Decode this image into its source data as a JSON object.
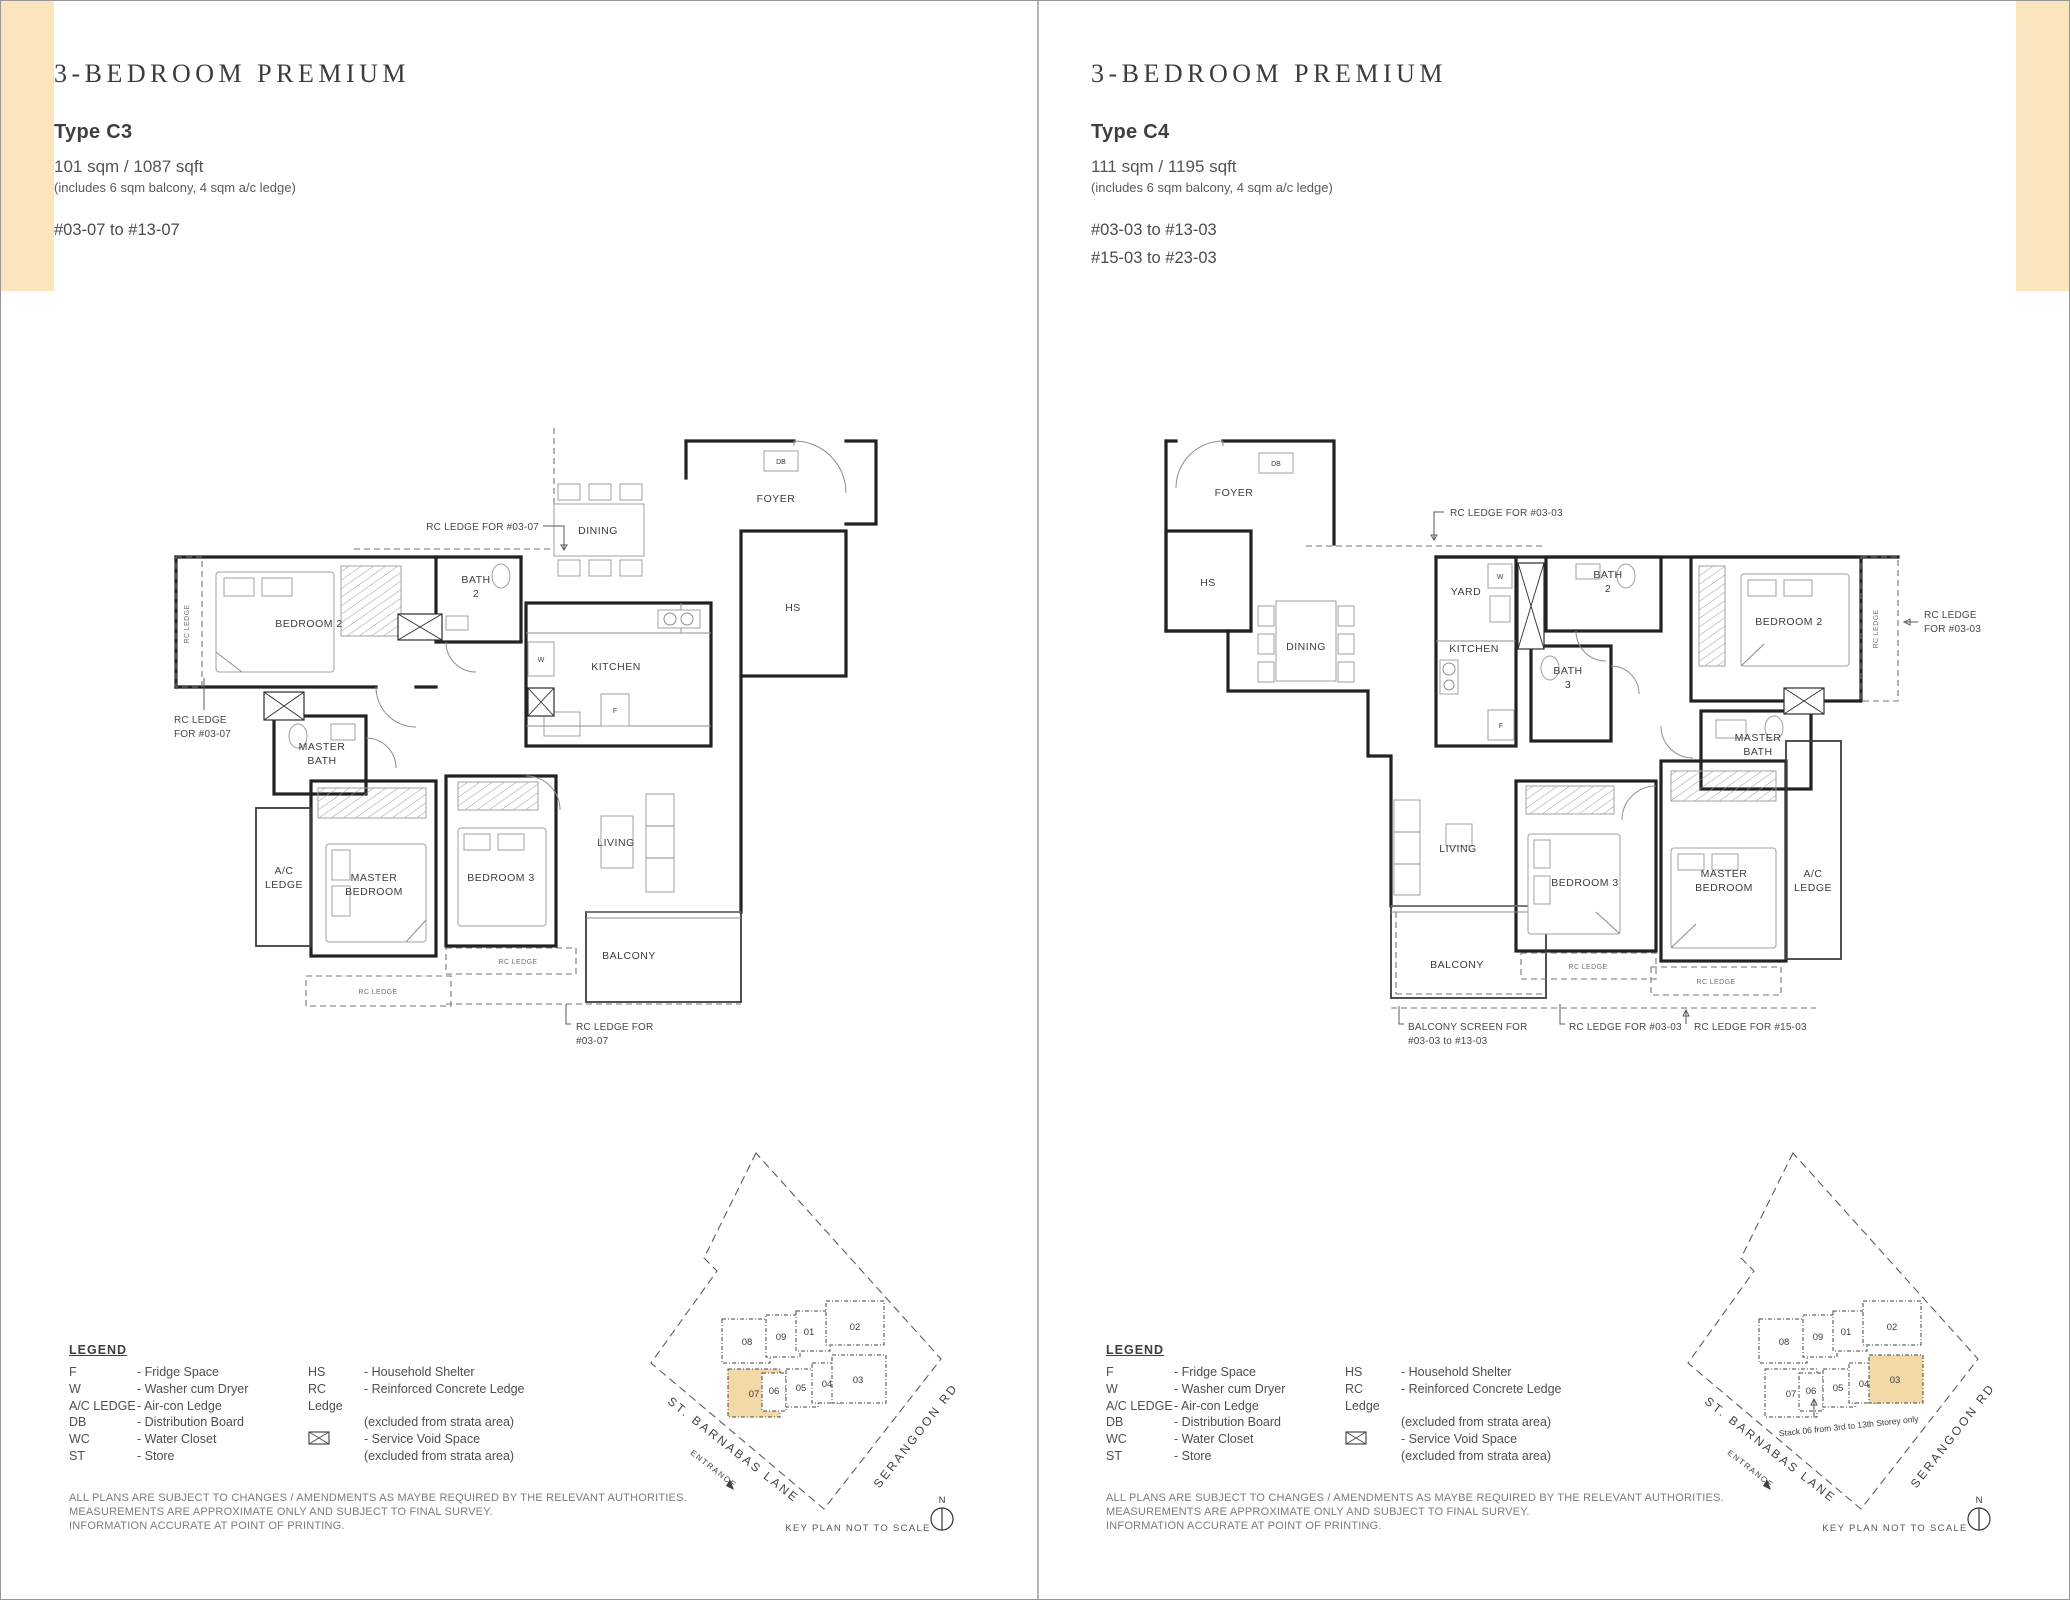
{
  "page": {
    "tab_color": "#fae5bd",
    "keyplan_highlight_color": "#f3d9a8"
  },
  "legend": {
    "heading": "LEGEND",
    "col1": [
      {
        "abbr": "F",
        "desc": "- Fridge Space"
      },
      {
        "abbr": "W",
        "desc": "- Washer cum Dryer"
      },
      {
        "abbr": "A/C LEDGE",
        "desc": "- Air-con Ledge"
      },
      {
        "abbr": "DB",
        "desc": "- Distribution Board"
      },
      {
        "abbr": "WC",
        "desc": "- Water Closet"
      },
      {
        "abbr": "ST",
        "desc": "- Store"
      }
    ],
    "col2_hs": {
      "abbr": "HS",
      "desc": "- Household Shelter"
    },
    "col2_rc": {
      "abbr": "RC Ledge",
      "desc": "- Reinforced Concrete Ledge",
      "desc2": "(excluded from strata area)"
    },
    "col2_sv": {
      "desc": "- Service Void Space",
      "desc2": "(excluded from strata area)"
    }
  },
  "disclaimer": [
    "ALL PLANS ARE SUBJECT TO CHANGES / AMENDMENTS AS MAYBE REQUIRED BY THE RELEVANT AUTHORITIES.",
    "MEASUREMENTS ARE APPROXIMATE ONLY AND SUBJECT TO FINAL SURVEY.",
    "INFORMATION ACCURATE AT POINT OF PRINTING."
  ],
  "key_plan": {
    "units_top": [
      "08",
      "09",
      "01",
      "02"
    ],
    "units_bottom": [
      "07",
      "06",
      "05",
      "04",
      "03"
    ],
    "street_left": "ST. BARNABAS LANE",
    "entrance_label": "ENTRANCE",
    "street_right": "SERANGOON RD",
    "scale_note": "KEY PLAN NOT TO SCALE",
    "north_label": "N"
  },
  "panels": [
    {
      "title": "3-BEDROOM PREMIUM",
      "type_label": "Type C3",
      "area": "101 sqm / 1087 sqft",
      "area_note": "(includes 6 sqm balcony, 4 sqm a/c ledge)",
      "stack_range_1": "#03-07 to #13-07",
      "key_plan_highlight": "07",
      "plan": {
        "foyer": "FOYER",
        "db": "DB",
        "hs": "HS",
        "dining": "DINING",
        "bath2_1": "BATH",
        "bath2_2": "2",
        "kitchen": "KITCHEN",
        "washer": "W",
        "fridge": "F",
        "bedroom2": "BEDROOM 2",
        "rc_ledge_vertical": "RC LEDGE",
        "master_bath_1": "MASTER",
        "master_bath_2": "BATH",
        "ac_ledge_1": "A/C",
        "ac_ledge_2": "LEDGE",
        "master_bedroom_1": "MASTER",
        "master_bedroom_2": "BEDROOM",
        "bedroom3": "BEDROOM 3",
        "living": "LIVING",
        "balcony": "BALCONY",
        "rc_ledge_small_1": "RC LEDGE",
        "rc_ledge_small_2": "RC LEDGE",
        "ann_top": "RC LEDGE FOR #03-07",
        "ann_left_1": "RC LEDGE",
        "ann_left_2": "FOR #03-07",
        "ann_bottom_1": "RC LEDGE FOR",
        "ann_bottom_2": "#03-07"
      }
    },
    {
      "title": "3-BEDROOM PREMIUM",
      "type_label": "Type C4",
      "area": "111 sqm / 1195 sqft",
      "area_note": "(includes 6 sqm balcony, 4 sqm a/c ledge)",
      "stack_range_1": "#03-03 to #13-03",
      "stack_range_2": "#15-03 to #23-03",
      "key_plan_highlight": "03",
      "stack_note": "Stack 06 from 3rd to 13th Storey only",
      "plan": {
        "foyer": "FOYER",
        "db": "DB",
        "hs": "HS",
        "dining": "DINING",
        "yard": "YARD",
        "washer": "W",
        "kitchen": "KITCHEN",
        "fridge": "F",
        "bath2_1": "BATH",
        "bath2_2": "2",
        "bath3_1": "BATH",
        "bath3_2": "3",
        "bedroom2": "BEDROOM 2",
        "rc_ledge_vertical": "RC LEDGE",
        "master_bath_1": "MASTER",
        "master_bath_2": "BATH",
        "living": "LIVING",
        "bedroom3": "BEDROOM 3",
        "master_bedroom_1": "MASTER",
        "master_bedroom_2": "BEDROOM",
        "ac_ledge_1": "A/C",
        "ac_ledge_2": "LEDGE",
        "balcony": "BALCONY",
        "rc_ledge_small_1": "RC LEDGE",
        "rc_ledge_small_2": "RC LEDGE",
        "ann_top": "RC LEDGE FOR #03-03",
        "ann_right_1": "RC LEDGE",
        "ann_right_2": "FOR #03-03",
        "ann_balcony_1": "BALCONY SCREEN FOR",
        "ann_balcony_2": "#03-03 to #13-03",
        "ann_bottom_left": "RC LEDGE FOR #03-03",
        "ann_bottom_right": "RC LEDGE FOR #15-03"
      }
    }
  ]
}
